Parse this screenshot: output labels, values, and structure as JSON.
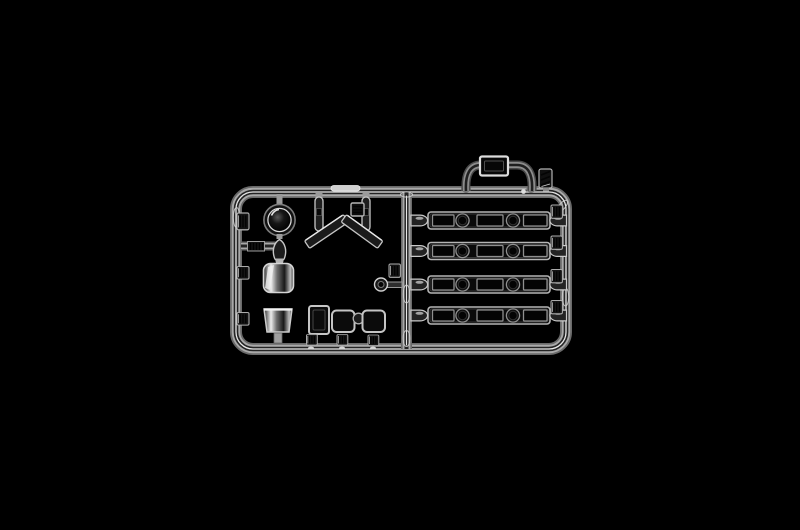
{
  "scene": {
    "description": "Studio product photograph of a clear transparent injection-molded model kit sprue (clear parts tree) centered on a pure black background",
    "object": "clear plastic sprue with vehicle glazing parts",
    "background_label": "black studio background"
  },
  "colors": {
    "background": "#000000",
    "plastic-bright": "#e8e8e8",
    "plastic-mid": "#a9a9a9",
    "plastic-core": "#242424",
    "part-dark": "#0a0a0a",
    "glass-dark": "#040404"
  },
  "parts": {
    "runner_frame": "rounded rectangular runner frame with one vertical center rail and a short cross rail",
    "window_strips": {
      "count": 4,
      "description": "long side-window strips, each with three rectangular panes and two round portholes, gated to the center and right rails"
    },
    "dome_lens": "dark round dome lens (beacon / searchlight glass) hanging from the top rail",
    "cylinder_lenses": {
      "count": 2,
      "description": "cylindrical cup-shaped clear lamp parts on the left column"
    },
    "windshield": "two-piece chevron (inverted-V) windscreen glazing",
    "pillar_posts": {
      "count": 2,
      "description": "short rounded pillar strips hanging from the top rail"
    },
    "square_pane_tag": "small square textured pane beside the right pillar post",
    "small_windows": {
      "count": 3,
      "description": "one tall window pane plus two rounded square panes joined by a small round lens, along the bottom rail"
    },
    "small_round_lens": "small round lens with stem gated to the center rail",
    "ribbed_tags": {
      "count": 10,
      "description": "ribbed molded part-number tabs along the rails"
    },
    "roof_pane_runner": "arched carry-handle shaped runner above the top rail holding one small rectangular pane and one diagonal ribbed tag"
  }
}
